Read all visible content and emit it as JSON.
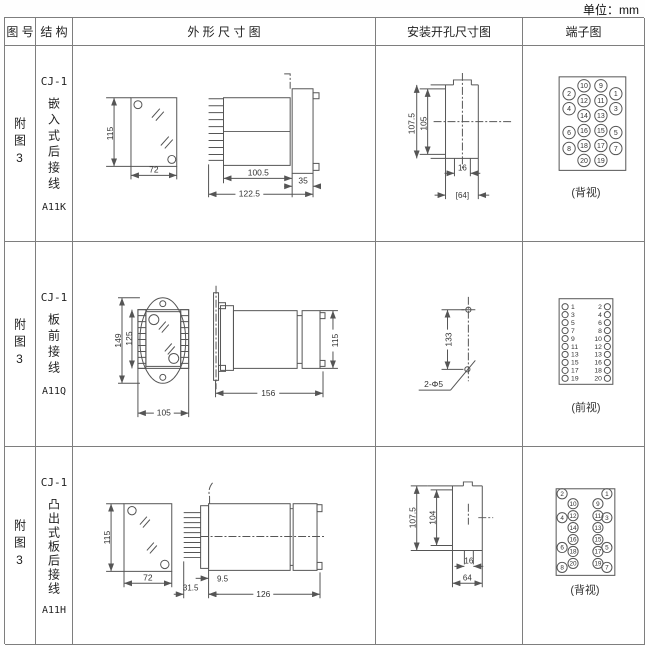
{
  "unit": "单位：mm",
  "header": {
    "fig": "图 号",
    "structure": "结 构",
    "outline": "外 形 尺 寸 图",
    "install": "安装开孔尺寸图",
    "terminal": "端子图"
  },
  "rows": [
    {
      "fig_no": "附图3",
      "series": "CJ-1",
      "mount": "嵌入式后接线",
      "model": "A11K",
      "outline": {
        "height": "115",
        "width": "72",
        "depth": "100.5",
        "panel": "35",
        "total_depth": "122.5"
      },
      "install": {
        "h1": "107.5",
        "h2": "105",
        "w1": "16",
        "w2": "[64]"
      },
      "terminal": {
        "caption": "(背视)",
        "inner_left": [
          "10",
          "12",
          "14",
          "16",
          "18",
          "20"
        ],
        "inner_right": [
          "9",
          "11",
          "13",
          "15",
          "17",
          "19"
        ],
        "outer_left": [
          "2",
          "4",
          "6",
          "8"
        ],
        "outer_right": [
          "1",
          "3",
          "5",
          "7"
        ]
      }
    },
    {
      "fig_no": "附图3",
      "series": "CJ-1",
      "mount": "板前接线",
      "model": "A11Q",
      "outline": {
        "height": "149",
        "inner_height": "125",
        "width": "105",
        "depth": "156",
        "side_height": "115"
      },
      "install": {
        "height": "133",
        "holes": "2-Φ5"
      },
      "terminal": {
        "caption": "(前视)",
        "left": [
          "1",
          "3",
          "5",
          "7",
          "9",
          "11",
          "13",
          "15",
          "17",
          "19"
        ],
        "right": [
          "2",
          "4",
          "6",
          "8",
          "10",
          "12",
          "13",
          "16",
          "18",
          "20"
        ]
      }
    },
    {
      "fig_no": "附图3",
      "series": "CJ-1",
      "mount": "凸出式板后接线",
      "model": "A11H",
      "outline": {
        "height": "115",
        "width": "72",
        "pin_depth": "31.5",
        "offset": "9.5",
        "depth": "126"
      },
      "install": {
        "h1": "107.5",
        "h2": "104",
        "w1": "16",
        "w2": "64"
      },
      "terminal": {
        "caption": "(背视)",
        "inner_left": [
          "10",
          "12",
          "14",
          "16",
          "18",
          "20"
        ],
        "inner_right": [
          "9",
          "11",
          "13",
          "15",
          "17",
          "19"
        ],
        "outer_left": [
          "2",
          "4",
          "6",
          "8"
        ],
        "outer_right": [
          "1",
          "3",
          "5",
          "7"
        ]
      }
    }
  ]
}
